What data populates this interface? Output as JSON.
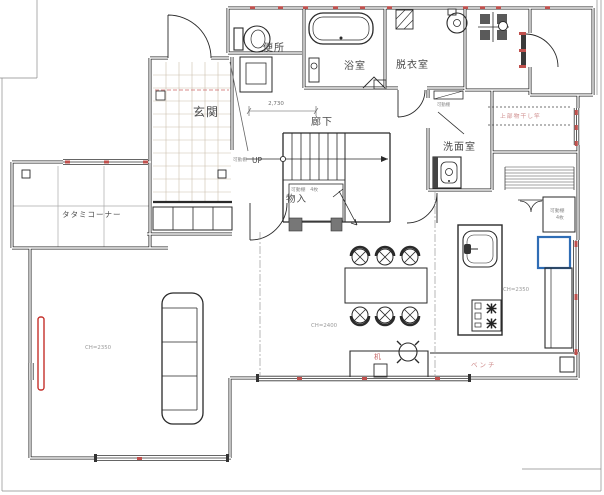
{
  "plan": {
    "rooms": {
      "toilet": "便所",
      "bath": "浴室",
      "dressing_room": "脱衣室",
      "entrance": "玄関",
      "corridor": "廊下",
      "washroom": "洗面室",
      "storage_closet": "物入",
      "tatami_corner": "タタミコーナー"
    },
    "labels": {
      "stairs_up": "UP",
      "corridor_dimension": "2,730",
      "movable_shelf": "可動棚",
      "movable_shelf_count": "4枚",
      "movable_shelf_with_count": "可動棚　4枚",
      "upper_laundry_pole": "上部物干し竿",
      "desk": "机",
      "bench": "ベンチ",
      "ch_living": "CH=2350",
      "ch_dining": "CH=2400",
      "ch_kitchen": "CH=2350"
    },
    "colors": {
      "wall": "#2a2a2a",
      "window_mark": "#c0504d",
      "note_pink": "#cf8d8d",
      "note_red": "#c76a6a",
      "refrigerator": "#2f6db5",
      "tv": "#c4302b"
    }
  }
}
